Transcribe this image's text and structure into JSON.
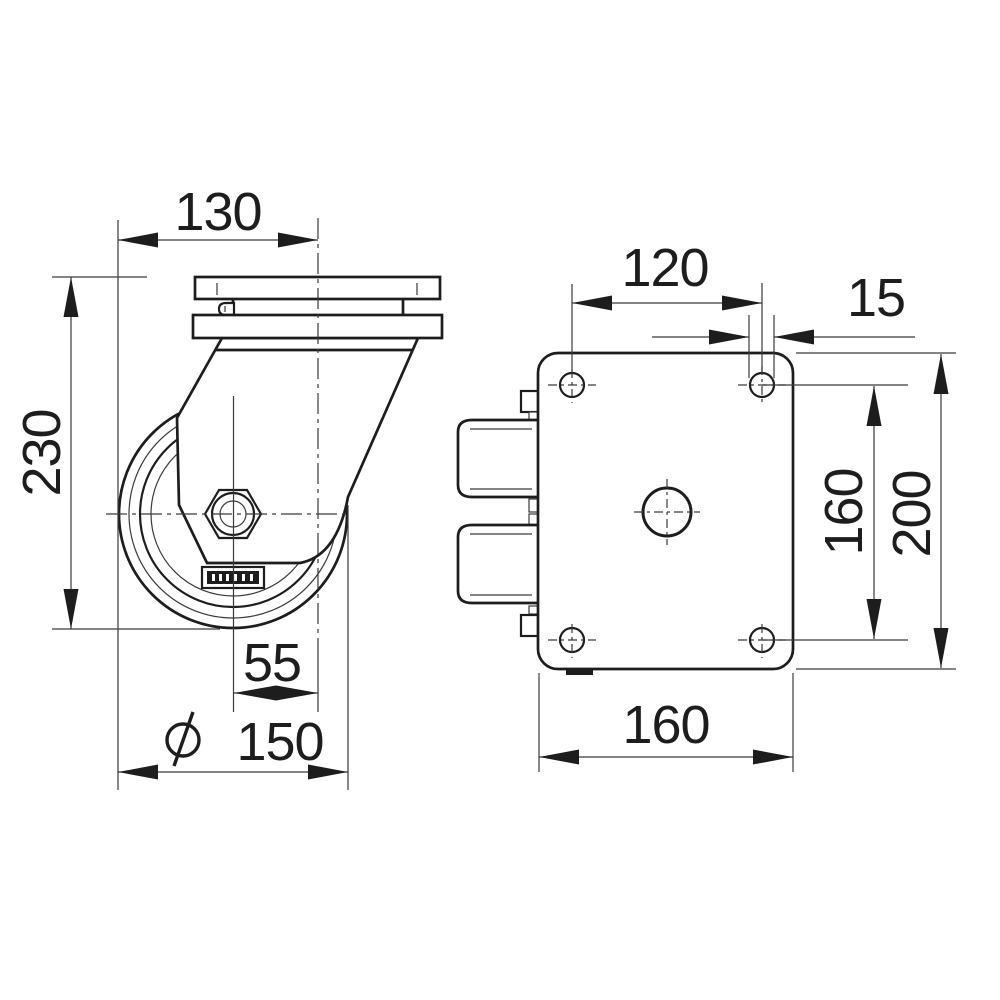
{
  "drawing": {
    "background": "#ffffff",
    "line_color": "#1d1d1d",
    "subject": "swivel caster technical drawing, side view and mounting plate view"
  },
  "dimensions": {
    "side": {
      "wheel_edge_to_swivel_axis": "130",
      "overall_height": "230",
      "swivel_offset": "55",
      "wheel_diameter_symbol": "⌀",
      "wheel_diameter": "150"
    },
    "plate": {
      "bolt_hole_spacing_x": "120",
      "bolt_hole_diameter": "15",
      "bolt_hole_spacing_y": "160",
      "plate_length": "200",
      "plate_width": "160"
    }
  }
}
